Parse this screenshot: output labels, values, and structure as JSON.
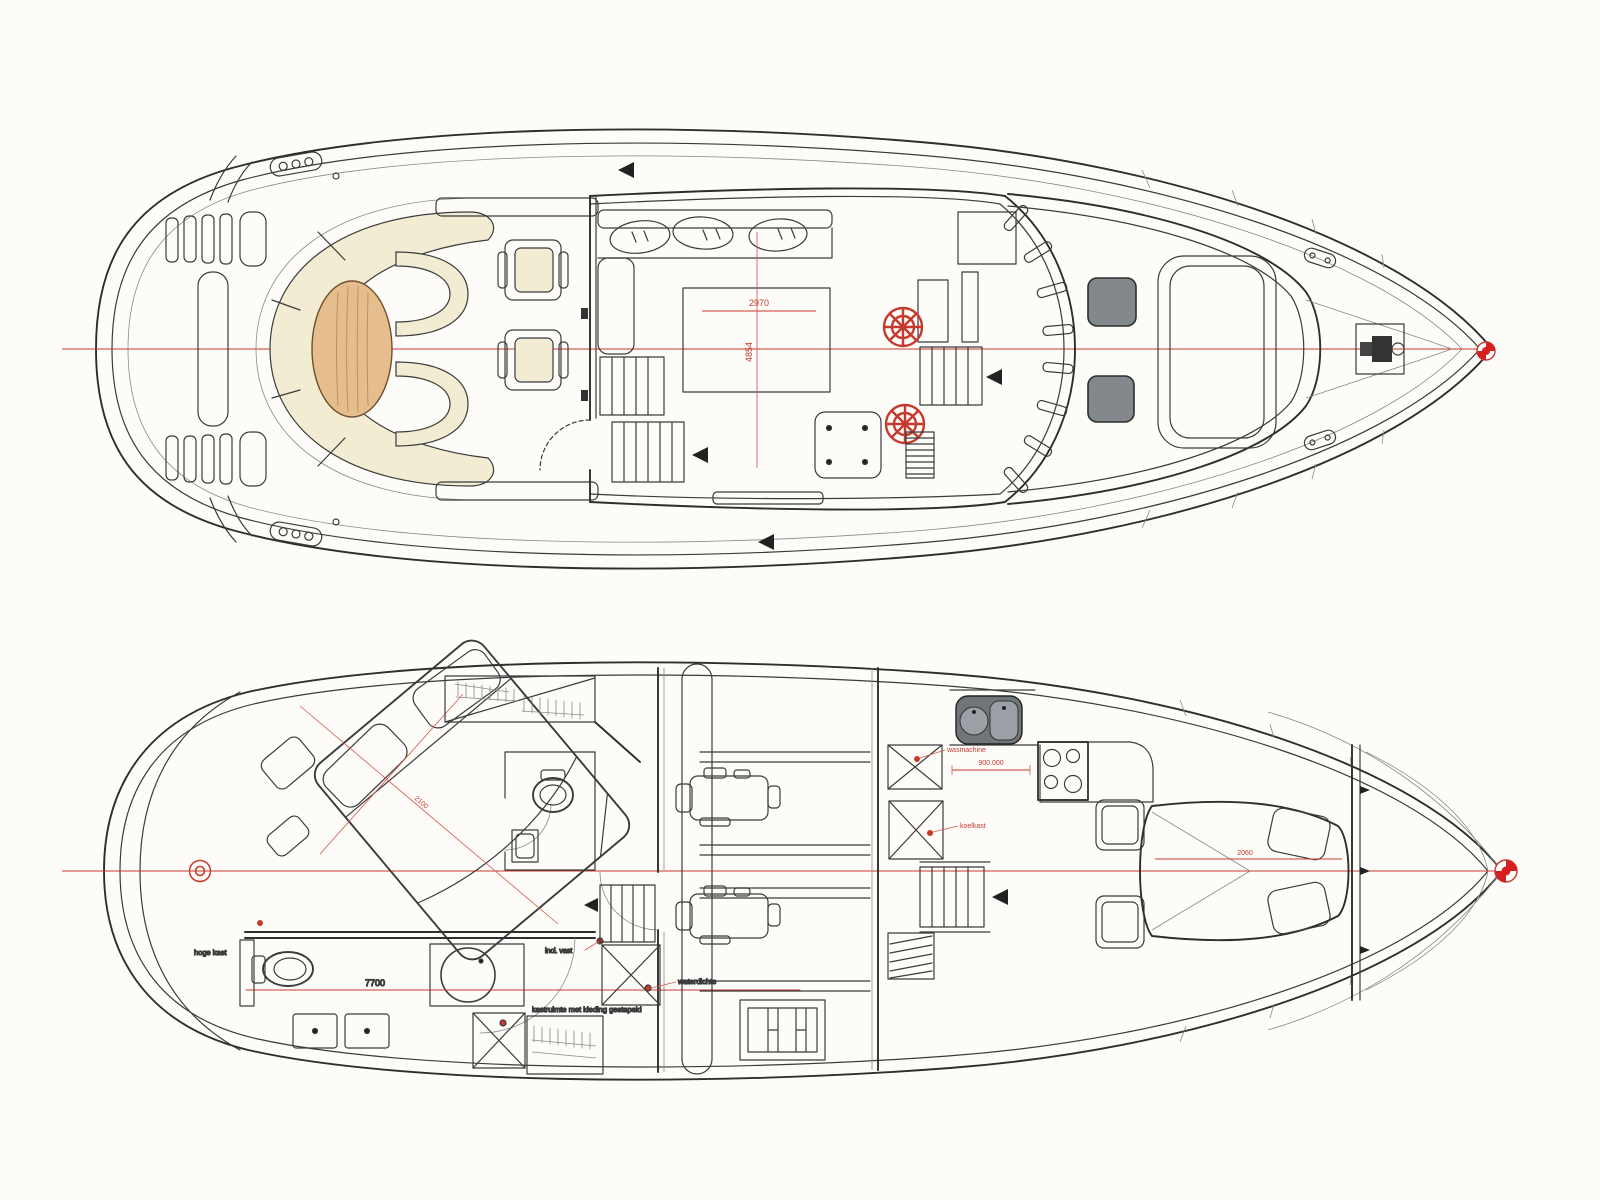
{
  "drawing": {
    "type": "yacht-general-arrangement",
    "views": [
      "upper-deck-plan",
      "lower-deck-plan"
    ]
  },
  "colors": {
    "centerline_red": "#c6392c",
    "seat_cream": "#f1ecd2",
    "table_wood": "#e6bd8d",
    "hatch_gray": "#83888d",
    "line_ink": "#3b3b3b"
  },
  "upper_deck": {
    "dims": {
      "table_width": "2970",
      "table_length": "4854"
    }
  },
  "lower_deck": {
    "dims": {
      "bed": "2100",
      "aft": "7700",
      "galley": "900.000",
      "vberth": "2060"
    },
    "labels": {
      "tall_cabinet": "hoge kast",
      "incl_vast": "incl. vast",
      "wardrobe": "kastruimte met kleding gestapeld",
      "watertight": "waterdichte",
      "washer": "wasmachine",
      "fridge": "koelkast"
    }
  }
}
